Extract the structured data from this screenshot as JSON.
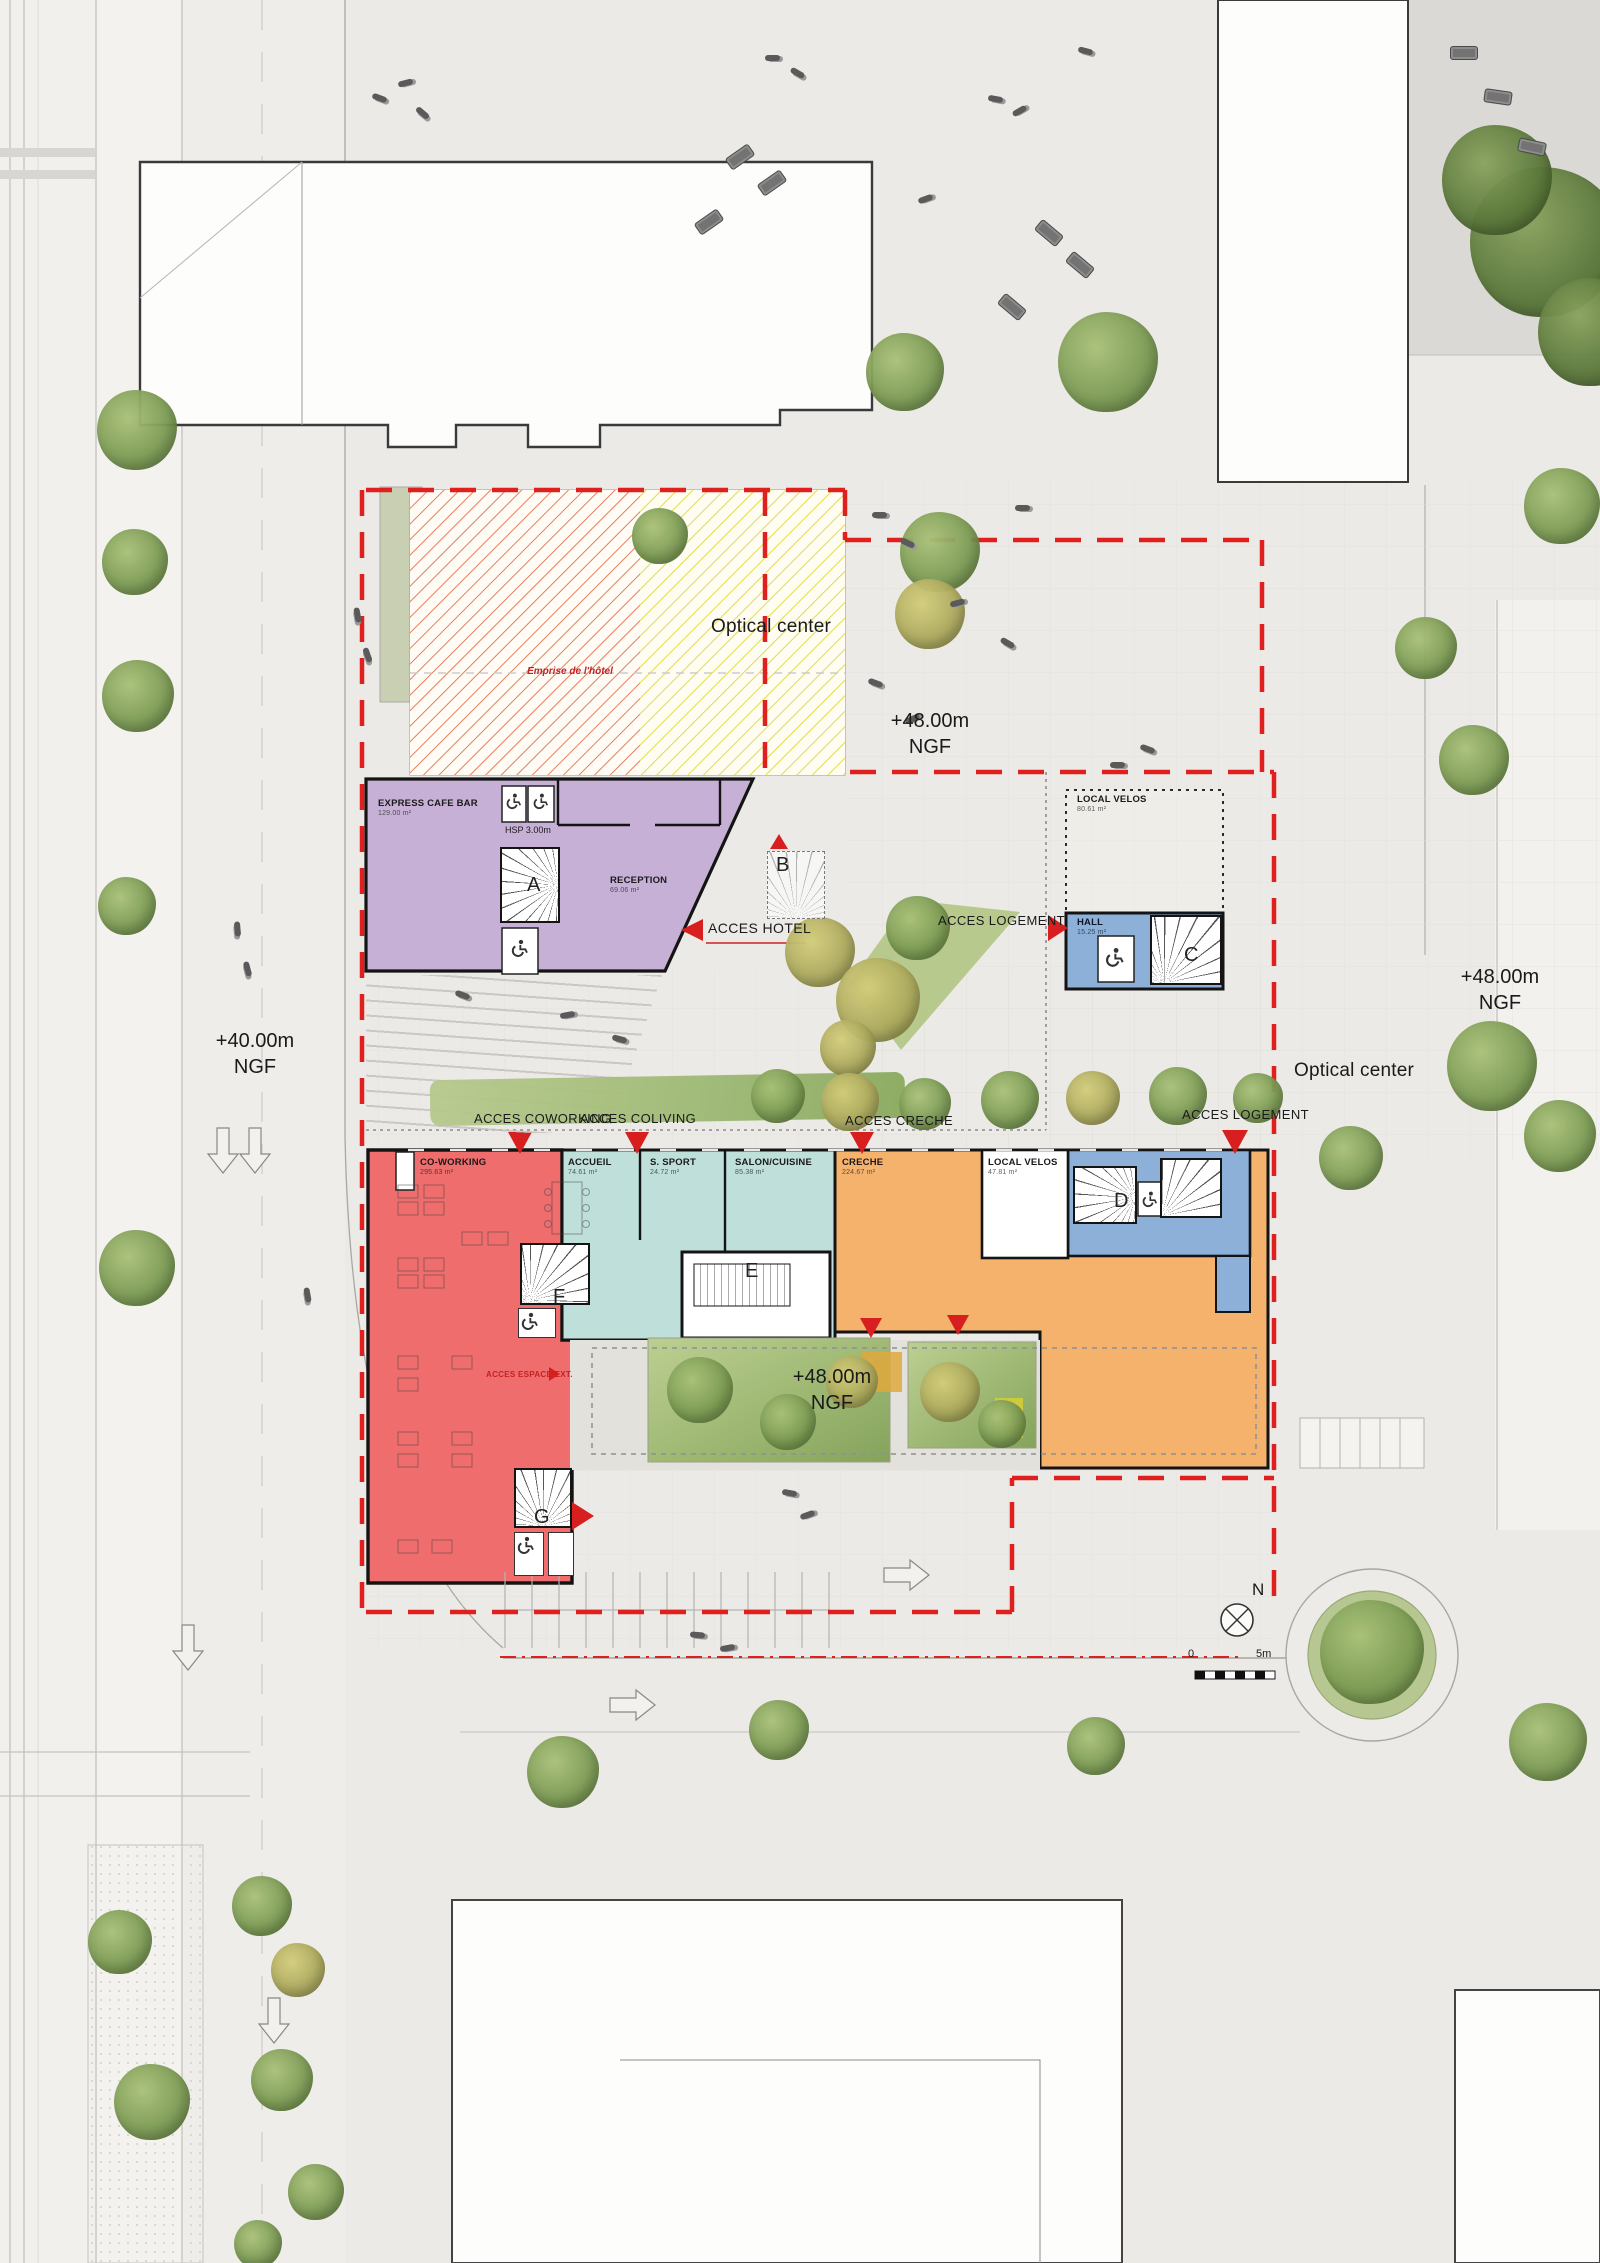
{
  "neighbors": {
    "optical_top": "Optical center",
    "optical_right": "Optical center"
  },
  "levels": {
    "ngf40_left": {
      "l1": "+40.00m",
      "l2": "NGF"
    },
    "ngf48_top": {
      "l1": "+48.00m",
      "l2": "NGF"
    },
    "ngf48_right": {
      "l1": "+48.00m",
      "l2": "NGF"
    },
    "ngf48_courtyard": {
      "l1": "+48.00m",
      "l2": "NGF"
    }
  },
  "site": {
    "emprise": "Emprise de l'hôtel"
  },
  "rooms": {
    "cafe": {
      "name": "EXPRESS CAFE BAR",
      "area": "129.00 m²"
    },
    "hsp": "HSP 3.00m",
    "reception": {
      "name": "RECEPTION",
      "area": "69.06 m²"
    },
    "velos_up": {
      "name": "LOCAL VELOS",
      "area": "80.61 m²"
    },
    "hall": {
      "name": "HALL",
      "area": "15.25 m²"
    },
    "coworking": {
      "name": "CO-WORKING",
      "area": "295.63 m²"
    },
    "accueil": {
      "name": "ACCUEIL",
      "area": "74.61 m²"
    },
    "sport": {
      "name": "S. SPORT",
      "area": "24.72 m²"
    },
    "salon": {
      "name": "SALON/CUISINE",
      "area": "85.38 m²"
    },
    "creche": {
      "name": "CRECHE",
      "area": "224.67 m²"
    },
    "velos_low": {
      "name": "LOCAL VELOS",
      "area": "47.81 m²"
    }
  },
  "access": {
    "hotel": "ACCES HOTEL",
    "logement_mid": "ACCES LOGEMENT",
    "coworking": "ACCES COWORKING",
    "coliving": "ACCES COLIVING",
    "creche": "ACCES CRECHE",
    "logement_low": "ACCES LOGEMENT",
    "espace_ext": "ACCES ESPACE EXT."
  },
  "stairs": {
    "a": "A",
    "b": "B",
    "c": "C",
    "d": "D",
    "e": "E",
    "f": "F",
    "g": "G"
  },
  "compass": {
    "north": "N"
  },
  "scalebar": {
    "zero": "0",
    "five": "5m"
  },
  "colors": {
    "hotel": "#c7b0d6",
    "coworking": "#ef6d6d",
    "coliving": "#bfe0da",
    "creche": "#f5b26d",
    "hall": "#8cb0d8",
    "accent": "#d81f1f",
    "hatch_yellow": "#ddd83e",
    "hatch_red": "#e46f4c",
    "grass": "#9cb873"
  }
}
